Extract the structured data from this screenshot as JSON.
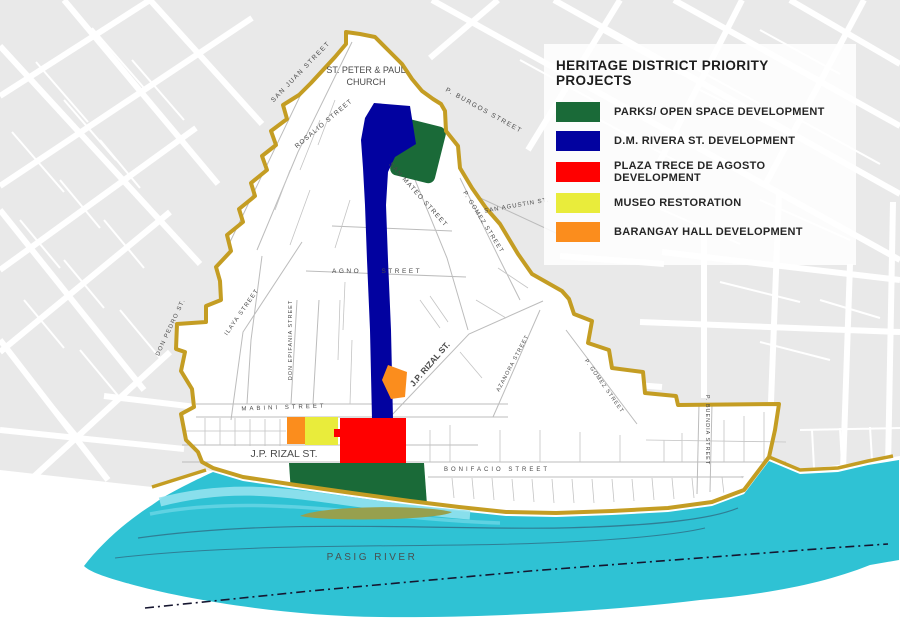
{
  "legend": {
    "title": "HERITAGE DISTRICT PRIORITY PROJECTS",
    "items": [
      {
        "id": "parks",
        "label": "PARKS/ OPEN SPACE DEVELOPMENT",
        "color": "#1a6a38"
      },
      {
        "id": "dmrivera",
        "label": "D.M. RIVERA ST. DEVELOPMENT",
        "color": "#0202a0"
      },
      {
        "id": "plaza",
        "label": "PLAZA TRECE DE AGOSTO DEVELOPMENT",
        "color": "#ff0000"
      },
      {
        "id": "museo",
        "label": "MUSEO RESTORATION",
        "color": "#e9ec3b"
      },
      {
        "id": "barangay",
        "label": "BARANGAY HALL DEVELOPMENT",
        "color": "#fb8d1d"
      }
    ]
  },
  "map": {
    "colors": {
      "outside_blocks": "#e9e9e9",
      "district_fill": "#ffffff",
      "district_boundary": "#c49d23",
      "river": "#2fc2d4",
      "river_band": "#93e2ee",
      "parks": "#1a6a38",
      "street_dev": "#0202a0",
      "plaza": "#ff0000",
      "museo": "#e9ec3b",
      "barangay": "#fb8d1d",
      "island": "#97a04e"
    },
    "landmarks": {
      "church_line1": "ST. PETER & PAUL",
      "church_line2": "CHURCH"
    },
    "river_label": "PASIG RIVER",
    "street_labels": [
      {
        "text": "SAN JUAN STREET"
      },
      {
        "text": "ROSALIO STREET"
      },
      {
        "text": "P. BURGOS STREET"
      },
      {
        "text": "SAN MATEO STREET"
      },
      {
        "text": "SAN AGUSTIN ST."
      },
      {
        "text": "P. GOMEZ STREET"
      },
      {
        "text": "AGNO STREET"
      },
      {
        "text": "DON PEDRO ST."
      },
      {
        "text": "ILAYA STREET"
      },
      {
        "text": "DON EPIFANIA STREET"
      },
      {
        "text": "J.P. RIZAL ST."
      },
      {
        "text": "MABINI STREET"
      },
      {
        "text": "J.P. RIZAL ST."
      },
      {
        "text": "BONIFACIO STREET"
      },
      {
        "text": "AZANORA STREET"
      },
      {
        "text": "P. GOMEZ STREET"
      },
      {
        "text": "P. BUENDIA STREET"
      }
    ]
  }
}
